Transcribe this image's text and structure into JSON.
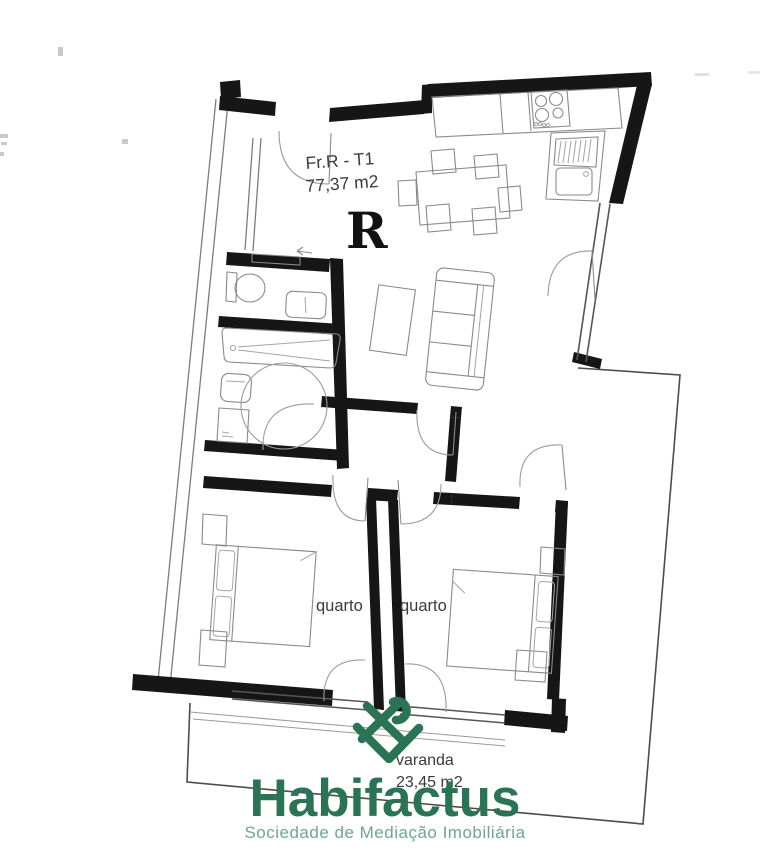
{
  "floor_plan": {
    "unit": {
      "label": "Fr.R - T1",
      "area": "77,37 m2",
      "room_letter": "R"
    },
    "rooms": {
      "bedroom1": {
        "label": "quarto"
      },
      "bedroom2": {
        "label": "quarto"
      },
      "balcony": {
        "label": "varanda",
        "area": "23,45 m2"
      }
    }
  },
  "branding": {
    "company": "Habifactus",
    "tagline": "Sociedade de Mediação Imobiliária",
    "logo_icon": "heart-ribbon-icon",
    "brand_green": "#2b7355",
    "tagline_green": "#6fa78c"
  },
  "style": {
    "wall_color": "#161616",
    "label_color": "#3b3b3b",
    "fixture_color": "#8a8a8a",
    "background": "#ffffff"
  }
}
